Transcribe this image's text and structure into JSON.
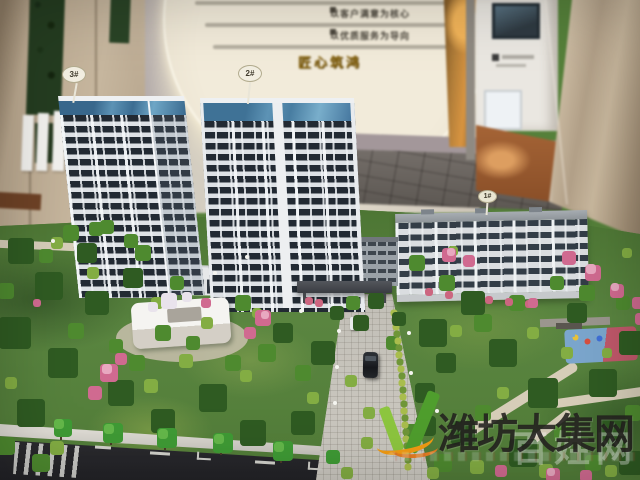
{
  "backdrop": {
    "slogans": [
      {
        "heading": "以客户满意为核心"
      },
      {
        "heading": "以优质服务为导向"
      }
    ],
    "seal": "匠心筑鸿"
  },
  "model": {
    "buildings": [
      {
        "label": "3#"
      },
      {
        "label": "2#"
      },
      {
        "label": "1#"
      }
    ]
  },
  "watermark": {
    "site_name": "潍坊大集网",
    "ghost_text": "百姓网",
    "colors": {
      "leaf_green": "#4f9e2d",
      "light_green": "#8dc63f",
      "swoosh_orange": "#f39c12",
      "text": "#211f1c"
    }
  },
  "palette": {
    "lawn_green": "#55803a",
    "tower_glass": "#222a33",
    "crown_blue": "#4e81a4",
    "flower_pink": "#d06a90",
    "wall_cream": "#ddd7ca",
    "pillar_tan": "#bfae97"
  }
}
